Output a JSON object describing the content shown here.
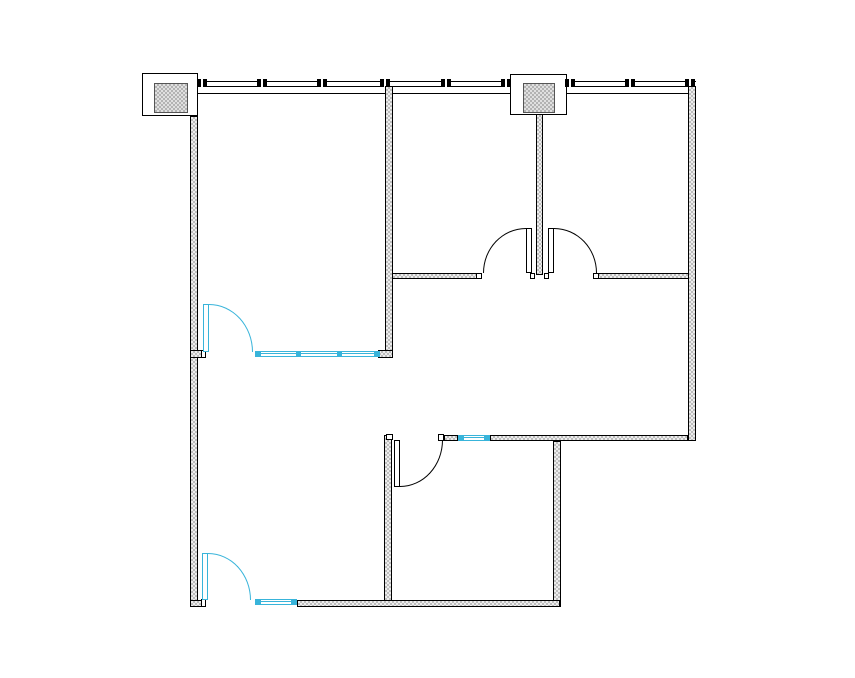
{
  "plan": {
    "canvas": {
      "width": 855,
      "height": 678,
      "background": "#ffffff"
    },
    "palette": {
      "line": "#000000",
      "wall_fill_dark": "#bdbdbd",
      "wall_fill_light": "#ededed",
      "glazing": "#38b4da",
      "white": "#ffffff"
    },
    "curtain_wall": {
      "segments": [
        {
          "x": 198,
          "y": 81,
          "w": 312,
          "h": 6
        },
        {
          "x": 567,
          "y": 81,
          "w": 129,
          "h": 6
        }
      ],
      "inner_line": {
        "x": 188,
        "y": 93,
        "w": 501,
        "h": 1
      },
      "mullion": {
        "y": 79,
        "w": 10,
        "h": 8
      },
      "mullions_x": [
        202,
        262,
        322,
        385,
        446,
        506,
        570,
        630,
        690
      ]
    },
    "columns": [
      {
        "name": "column-enclosure-a",
        "box": {
          "x": 142,
          "y": 73,
          "w": 56,
          "h": 43
        },
        "pad": {
          "x": 154,
          "y": 83,
          "w": 34,
          "h": 30
        }
      },
      {
        "name": "column-enclosure-b",
        "box": {
          "x": 510,
          "y": 74,
          "w": 57,
          "h": 41
        },
        "pad": {
          "x": 523,
          "y": 83,
          "w": 32,
          "h": 30
        }
      }
    ],
    "walls": [
      {
        "name": "wall-left",
        "x": 190,
        "y": 116,
        "w": 8,
        "h": 491
      },
      {
        "name": "wall-mid-upper",
        "x": 385,
        "y": 86,
        "w": 8,
        "h": 272
      },
      {
        "name": "wall-column-stub",
        "x": 536,
        "y": 114,
        "w": 7,
        "h": 161
      },
      {
        "name": "wall-right",
        "x": 688,
        "y": 86,
        "w": 8,
        "h": 355
      },
      {
        "name": "wall-room1-south-stub-left",
        "x": 190,
        "y": 350,
        "w": 13,
        "h": 8
      },
      {
        "name": "wall-room1-south-stub-right",
        "x": 378,
        "y": 350,
        "w": 15,
        "h": 8
      },
      {
        "name": "wall-hall-north-left",
        "x": 392,
        "y": 273,
        "w": 90,
        "h": 6
      },
      {
        "name": "wall-hall-north-right",
        "x": 595,
        "y": 273,
        "w": 94,
        "h": 6
      },
      {
        "name": "wall-mid-lower",
        "x": 384,
        "y": 435,
        "w": 8,
        "h": 172
      },
      {
        "name": "wall-room3-north-a",
        "x": 444,
        "y": 435,
        "w": 14,
        "h": 6
      },
      {
        "name": "wall-room3-north-b",
        "x": 490,
        "y": 435,
        "w": 198,
        "h": 6
      },
      {
        "name": "wall-lower-right",
        "x": 553,
        "y": 441,
        "w": 8,
        "h": 166
      },
      {
        "name": "wall-bottom-stub-left",
        "x": 190,
        "y": 600,
        "w": 13,
        "h": 7
      },
      {
        "name": "wall-bottom",
        "x": 297,
        "y": 600,
        "w": 263,
        "h": 7
      }
    ],
    "interior_windows": [
      {
        "name": "glazed-partition-room1",
        "x": 255,
        "y": 351,
        "w": 125,
        "h": 6,
        "caps": [
          1,
          41,
          82,
          119
        ]
      },
      {
        "name": "glazed-partition-room3",
        "x": 458,
        "y": 435,
        "w": 32,
        "h": 6,
        "caps": [
          1,
          26
        ]
      },
      {
        "name": "glazed-partition-room4",
        "x": 255,
        "y": 599,
        "w": 42,
        "h": 6,
        "caps": [
          1,
          36
        ]
      }
    ],
    "jambs": [
      {
        "name": "jamb-room1-door",
        "x": 201,
        "y": 350,
        "w": 5,
        "h": 8
      },
      {
        "name": "jamb-double-door-left",
        "x": 476,
        "y": 273,
        "w": 6,
        "h": 6
      },
      {
        "name": "jamb-double-door-right",
        "x": 593,
        "y": 273,
        "w": 6,
        "h": 6
      },
      {
        "name": "jamb-stub-left",
        "x": 530,
        "y": 273,
        "w": 5,
        "h": 6
      },
      {
        "name": "jamb-stub-right",
        "x": 544,
        "y": 273,
        "w": 5,
        "h": 6
      },
      {
        "name": "jamb-room3-door",
        "x": 438,
        "y": 434,
        "w": 6,
        "h": 7
      },
      {
        "name": "jamb-mid-lower-cap",
        "x": 386,
        "y": 434,
        "w": 7,
        "h": 6
      },
      {
        "name": "jamb-room4-door",
        "x": 201,
        "y": 599,
        "w": 5,
        "h": 8
      }
    ],
    "doors": [
      {
        "name": "door-room1",
        "color": "glazing",
        "leaf": {
          "x": 203,
          "y": 304,
          "w": 6,
          "h": 48
        },
        "arc": {
          "x": 209,
          "y": 304,
          "w": 44,
          "h": 48,
          "corner": "tr"
        }
      },
      {
        "name": "door-room4",
        "color": "glazing",
        "leaf": {
          "x": 202,
          "y": 553,
          "w": 6,
          "h": 47
        },
        "arc": {
          "x": 208,
          "y": 553,
          "w": 43,
          "h": 47,
          "corner": "tr"
        }
      },
      {
        "name": "door-double-left",
        "color": "line",
        "leaf": {
          "x": 526,
          "y": 228,
          "w": 6,
          "h": 45
        },
        "arc": {
          "x": 483,
          "y": 228,
          "w": 43,
          "h": 45,
          "corner": "tl"
        }
      },
      {
        "name": "door-double-right",
        "color": "line",
        "leaf": {
          "x": 548,
          "y": 228,
          "w": 6,
          "h": 45
        },
        "arc": {
          "x": 554,
          "y": 228,
          "w": 43,
          "h": 45,
          "corner": "tr"
        }
      },
      {
        "name": "door-room3",
        "color": "line",
        "leaf": {
          "x": 394,
          "y": 440,
          "w": 6,
          "h": 47
        },
        "arc": {
          "x": 400,
          "y": 440,
          "w": 43,
          "h": 47,
          "corner": "br"
        }
      }
    ]
  }
}
